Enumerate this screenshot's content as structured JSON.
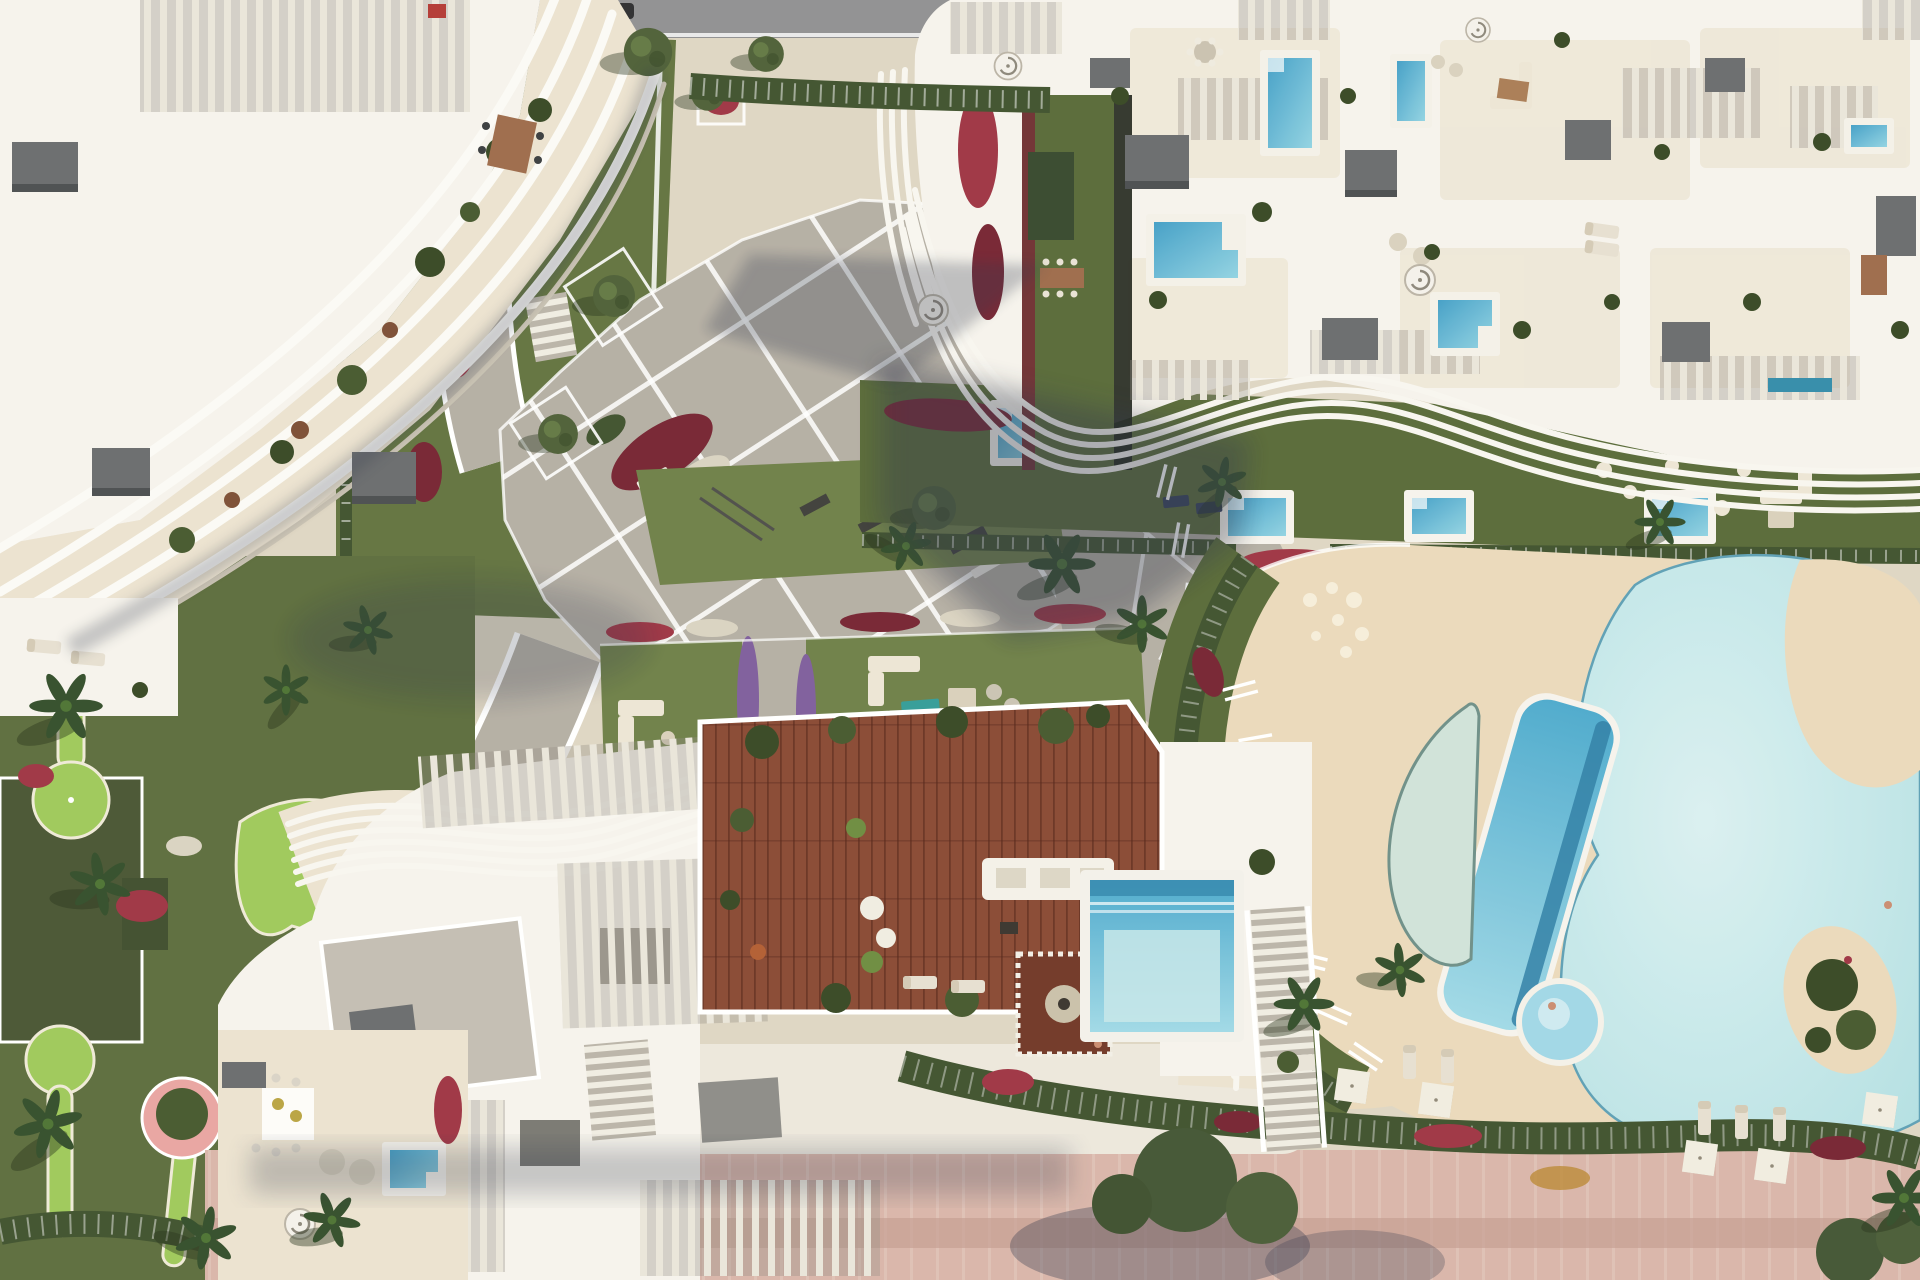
{
  "meta": {
    "description": "Top-down aerial architectural rendering of a coastal residential resort complex with three apartment buildings, landscaped gardens and a freeform pool club",
    "render_style": "photorealistic CGI masterplan",
    "orientation": "top-down plan view"
  },
  "palette": {
    "stone": "#ded5c2",
    "stone-light": "#ebe2cf",
    "roof-white": "#f6f3ec",
    "paving": "#b3ada2",
    "road": "#8e8e90",
    "lawn": "#6b7d44",
    "lawn-dark": "#52643326",
    "lawn-solid": "#556734",
    "golf": "#9cc857",
    "hedge": "#3c4e2a",
    "water-deep": "#2a7ba3",
    "water-mid": "#4aa6cb",
    "water-light": "#9fd6e6",
    "water-pale": "#cfe2d8",
    "lagoon": "#c2e6e8",
    "sand": "#ead9ba",
    "deck-wood": "#86452f",
    "flower-red": "#9c3040",
    "flower-crimson": "#731f2e",
    "flower-purple": "#7c5a9a",
    "roof-box": "#67696b",
    "promenade": "#d8b4a8",
    "wood-table": "#9b6847",
    "pink-planter": "#e8a3a0",
    "teal-rug": "#2f9a96",
    "white": "#ffffff",
    "shadow-col": "#2a3147"
  },
  "scene": {
    "buildings": [
      {
        "id": "northwest-residence",
        "roof": "white flat roof",
        "facade": "curved white louver fins over beige terraces",
        "details": [
          "slatted roof pergola",
          "rooftop dining table",
          "grey vent boxes",
          "west terrace with sun loungers"
        ]
      },
      {
        "id": "northeast-residence",
        "roof": "cream penthouse level",
        "details": [
          "plunge pools",
          "slatted pergolas",
          "roof gardens",
          "spiral stairs",
          "outdoor lounges",
          "wavy fin canopy on south edge",
          "green roof strip with dining table"
        ]
      },
      {
        "id": "south-residence",
        "roof": "white roof with wavy pergola fins",
        "details": [
          "hardwood sun deck",
          "stepped rooftop pool",
          "dining pavilion with round rug",
          "vertical slat screens",
          "west terrace with dining table and plunge pool",
          "east stairs"
        ]
      }
    ],
    "pools": [
      {
        "id": "lagoon-pool",
        "shape": "freeform",
        "water": "pale turquoise",
        "features": [
          "sand beach entry",
          "planted island"
        ]
      },
      {
        "id": "lap-pool",
        "shape": "elongated rounded rectangle, tilted",
        "water": "turquoise with dark tile band"
      },
      {
        "id": "crescent-reflection-pool",
        "shape": "crescent",
        "water": "pale green"
      },
      {
        "id": "round-spa-pool",
        "shape": "circle",
        "water": "light blue",
        "occupant": "one bather"
      },
      {
        "id": "garden-plunge-pools",
        "count": 5
      },
      {
        "id": "terrace-plunge-pools",
        "count": 5
      },
      {
        "id": "northwest-garden-pool",
        "count": 1
      }
    ],
    "landscape": {
      "plaza": "diagonal paved plaza with white grid joints and inset flower beds",
      "paths": [
        "winding south-west garden path lined with purple bougainvillea",
        "wide path from plaza to pool club"
      ],
      "putting_greens": 3,
      "palm_trees": 14,
      "olive_trees": 6,
      "planting": [
        "red bougainvillea drifts",
        "purple bougainvillea",
        "white flowering hedges",
        "clipped dark hedges"
      ],
      "amenities": [
        "outdoor gym lawn",
        "lounge lawns with sofas",
        "sun loungers",
        "white square parasols",
        "pergola trellises",
        "benches",
        "pink round planter"
      ]
    },
    "ground_features": {
      "road": "grey asphalt road with white curb, parked dark car, top edge",
      "promenade": "pink sand promenade with mauve strip along bottom edge"
    }
  }
}
